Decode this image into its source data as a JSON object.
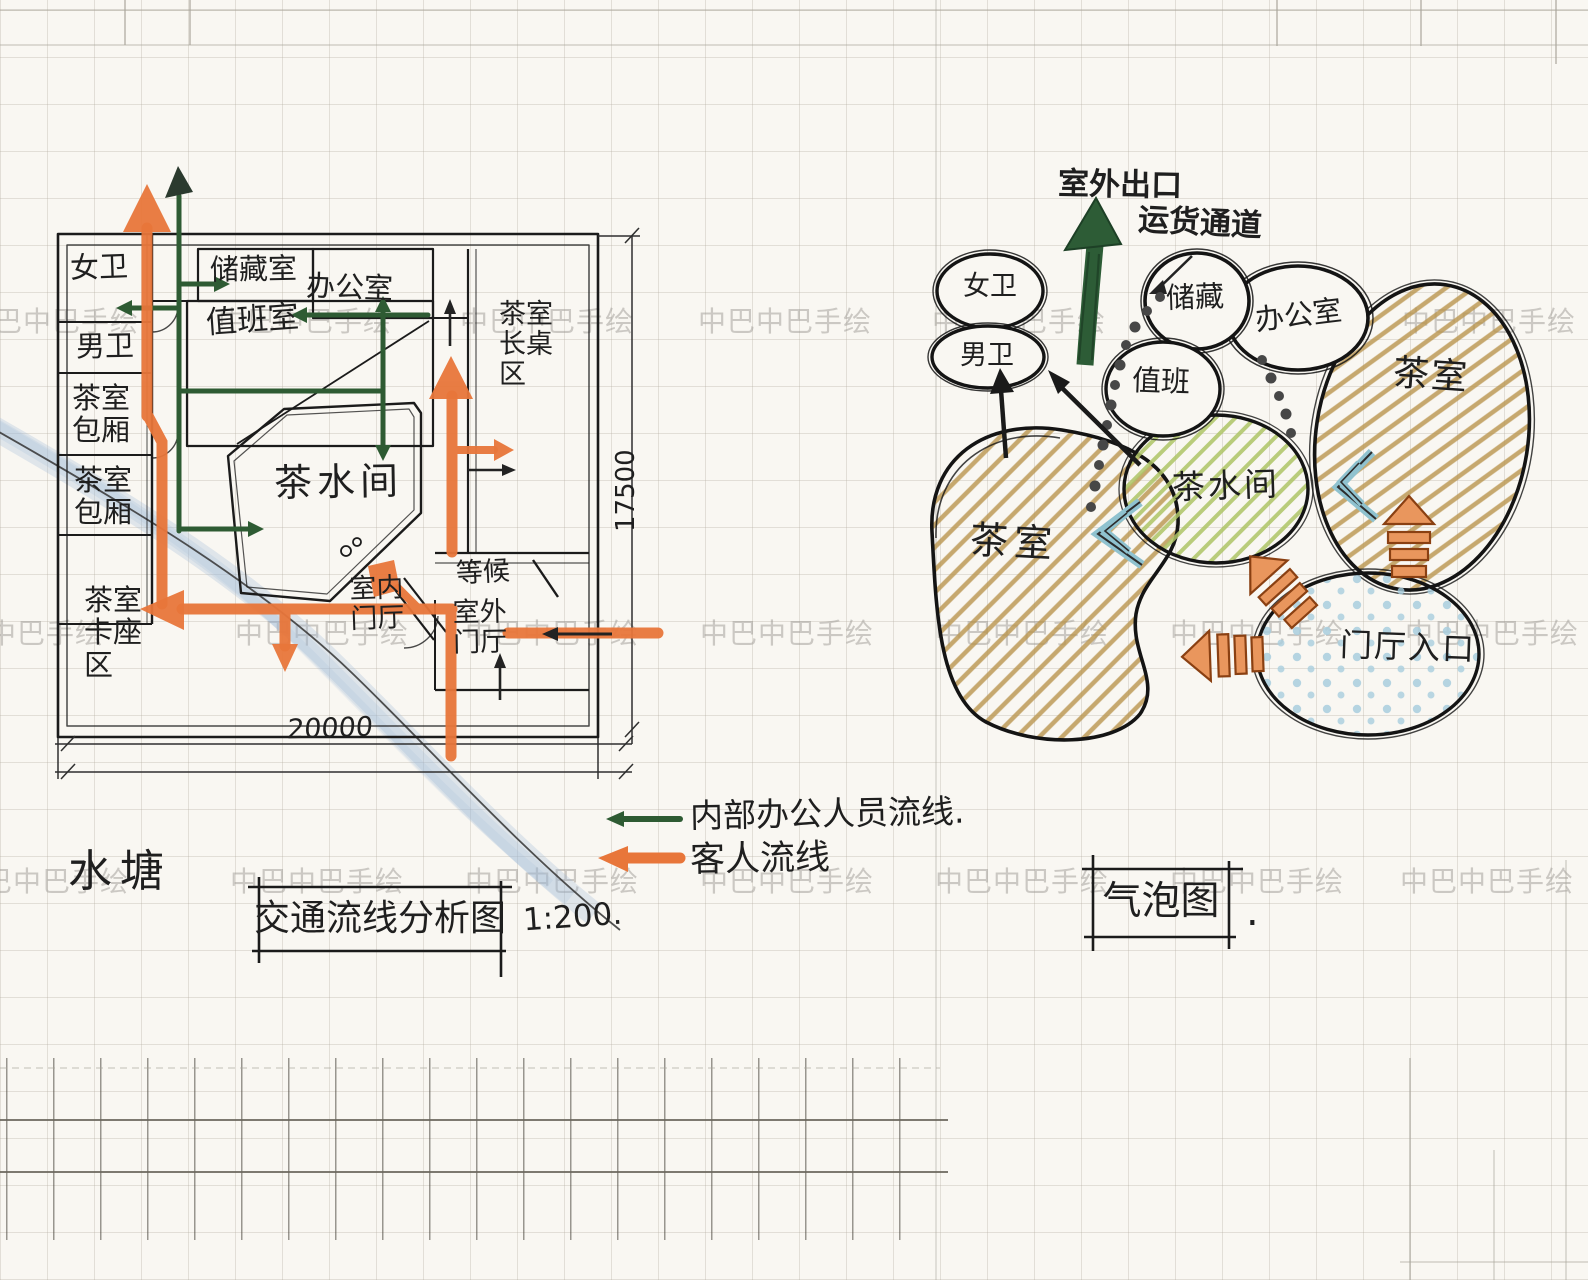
{
  "colors": {
    "ink": "#1f1f1f",
    "paper": "#f9f7f2",
    "orange": "#e8763a",
    "orange-fill": "#e9965d",
    "green": "#2e5b33",
    "green-dark": "#2d5c36",
    "tan": "#b9954d",
    "hatch-green": "#aec566",
    "blue-dots": "#a9cede",
    "chevron-blue": "#8fc2cf",
    "watermark": "#9e9b96"
  },
  "watermark": {
    "text": "中巴中巴手绘"
  },
  "plan": {
    "title": "交通流线分析图",
    "scale": "1:200.",
    "pond": "水塘",
    "dim_bottom": "20000",
    "dim_right": "17500",
    "legend_staff": "内部办公人员流线.",
    "legend_guest": "客人流线",
    "rooms": {
      "women_wc": "女卫",
      "men_wc": "男卫",
      "private_room_1": "茶室包厢",
      "private_room_2": "茶室包厢",
      "booth_area": "茶室卡座区",
      "storage": "储藏室",
      "duty": "值班室",
      "office": "办公室",
      "pantry": "茶水间",
      "long_table": "茶室长桌区",
      "indoor_foyer": "室内门厅",
      "waiting": "等候",
      "outdoor_foyer": "室外门厅"
    }
  },
  "bubble": {
    "title": "气泡图",
    "period": ".",
    "labels": {
      "outdoor_exit": "室外出口",
      "freight_passage": "运货通道",
      "women_wc": "女卫",
      "men_wc": "男卫",
      "storage": "储藏",
      "duty": "值班",
      "office": "办公室",
      "tea_room_right": "茶室",
      "pantry": "茶水间",
      "tea_room_left": "茶室",
      "entrance": "门厅入口"
    }
  }
}
